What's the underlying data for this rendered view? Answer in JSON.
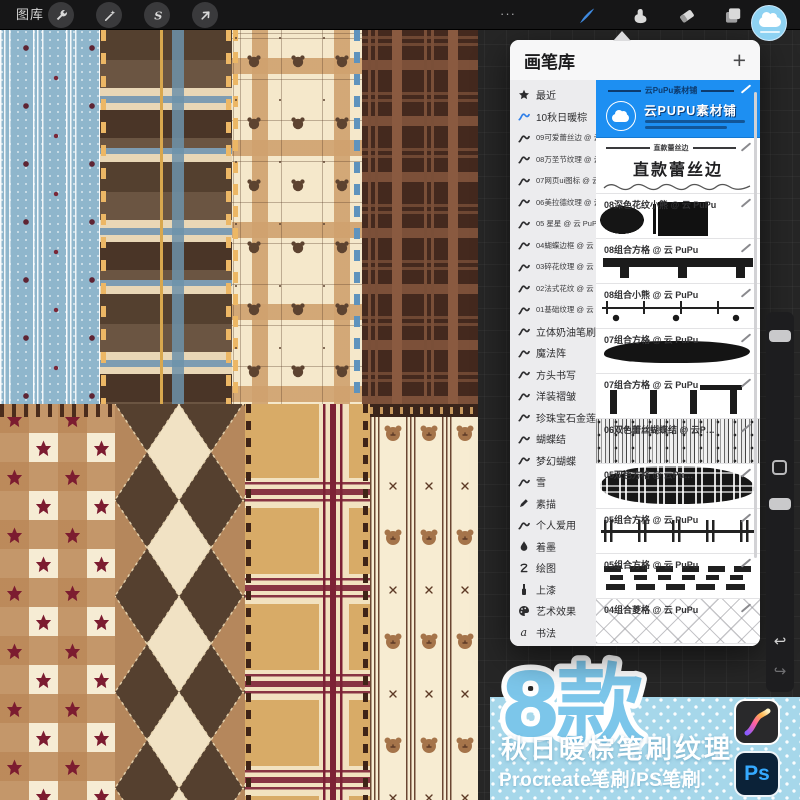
{
  "toolbar": {
    "gallery_label": "图库",
    "ellipsis": "···",
    "left_tools": [
      "actions-wrench",
      "adjustments-wand",
      "selection-s",
      "transform-arrow"
    ],
    "right_tools": [
      "brush",
      "smudge",
      "eraser",
      "layers",
      "color"
    ]
  },
  "panel": {
    "title": "画笔库",
    "add_label": "+",
    "sidebar": [
      {
        "icon": "star",
        "label": "最近"
      },
      {
        "icon": "brush",
        "label": "10秋日暖棕",
        "selected": true
      },
      {
        "icon": "brush",
        "label": "09可爱蕾丝边 @ 云 Pu…",
        "small": true
      },
      {
        "icon": "brush",
        "label": "08万圣节纹理 @ 云 Pu…",
        "small": true
      },
      {
        "icon": "brush",
        "label": "07网页ui图标 @ 云 Pu…",
        "small": true
      },
      {
        "icon": "brush",
        "label": "06美拉德纹理 @ 云 Pu…",
        "small": true
      },
      {
        "icon": "brush",
        "label": "05 星星 @ 云 PuPu 1",
        "small": true
      },
      {
        "icon": "brush",
        "label": "04蝴蝶边框 @ 云 PuPu",
        "small": true
      },
      {
        "icon": "brush",
        "label": "03碎花纹理 @ 云 PuPu",
        "small": true
      },
      {
        "icon": "brush",
        "label": "02法式花纹 @ 云 PuPu",
        "small": true
      },
      {
        "icon": "brush",
        "label": "01基础纹理 @ 云 PuPu",
        "small": true
      },
      {
        "icon": "brush",
        "label": "立体奶油笔刷"
      },
      {
        "icon": "brush",
        "label": "魔法阵"
      },
      {
        "icon": "brush",
        "label": "方头书写"
      },
      {
        "icon": "brush",
        "label": "洋装褶皱"
      },
      {
        "icon": "brush",
        "label": "珍珠宝石金莲"
      },
      {
        "icon": "brush",
        "label": "蝴蝶结"
      },
      {
        "icon": "brush",
        "label": "梦幻蝴蝶"
      },
      {
        "icon": "brush",
        "label": "雪"
      },
      {
        "icon": "pencil",
        "label": "素描"
      },
      {
        "icon": "brush",
        "label": "个人爱用"
      },
      {
        "icon": "ink",
        "label": "着墨"
      },
      {
        "icon": "scribble",
        "label": "绘图"
      },
      {
        "icon": "paint",
        "label": "上漆"
      },
      {
        "icon": "palette",
        "label": "艺术效果"
      },
      {
        "icon": "calligraphy",
        "label": "书法"
      }
    ],
    "cards": [
      {
        "type": "featured",
        "title_line": "云PuPu素材铺",
        "name": "云PUPU素材铺"
      },
      {
        "type": "lace",
        "small_title": "直款蕾丝边",
        "big_title": "直款蕾丝边"
      },
      {
        "title": "08深色花纹小熊 @ 云 PuPu",
        "preview": "dark-bear"
      },
      {
        "title": "08组合方格 @ 云 PuPu",
        "preview": "bar-tabs"
      },
      {
        "title": "08组合小熊 @ 云 PuPu",
        "preview": "line-ticks"
      },
      {
        "title": "07组合方格 @ 云 PuPu",
        "preview": "blob"
      },
      {
        "title": "07组合方格 @ 云 PuPu",
        "preview": "vbars"
      },
      {
        "title": "06双色蕾丝蝴蝶结 @ 云P…",
        "preview": "grain-stripes"
      },
      {
        "title": "05双色方格 @ 云Pu…",
        "preview": "plaid-blob"
      },
      {
        "title": "05组合方格 @ 云 PuPu",
        "preview": "line-double-ticks"
      },
      {
        "title": "05组合方格 @ 云 PuPu",
        "preview": "dash-rows"
      },
      {
        "title": "04组合菱格 @ 云 PuPu",
        "preview": "lattice"
      }
    ]
  },
  "promo": {
    "badge": "8款",
    "title": "秋日暖棕笔刷纹理",
    "subtitle": "Procreate笔刷/PS笔刷",
    "ps_label": "Ps",
    "bg_color": "#a6d7ea",
    "badge_color": "#7cc6ea",
    "ps_blue": "#35aaff"
  },
  "colors": {
    "accent_blue": "#1d8ff2",
    "toolbar_bg": "#161617",
    "panel_bg": "#f7f7f8"
  }
}
